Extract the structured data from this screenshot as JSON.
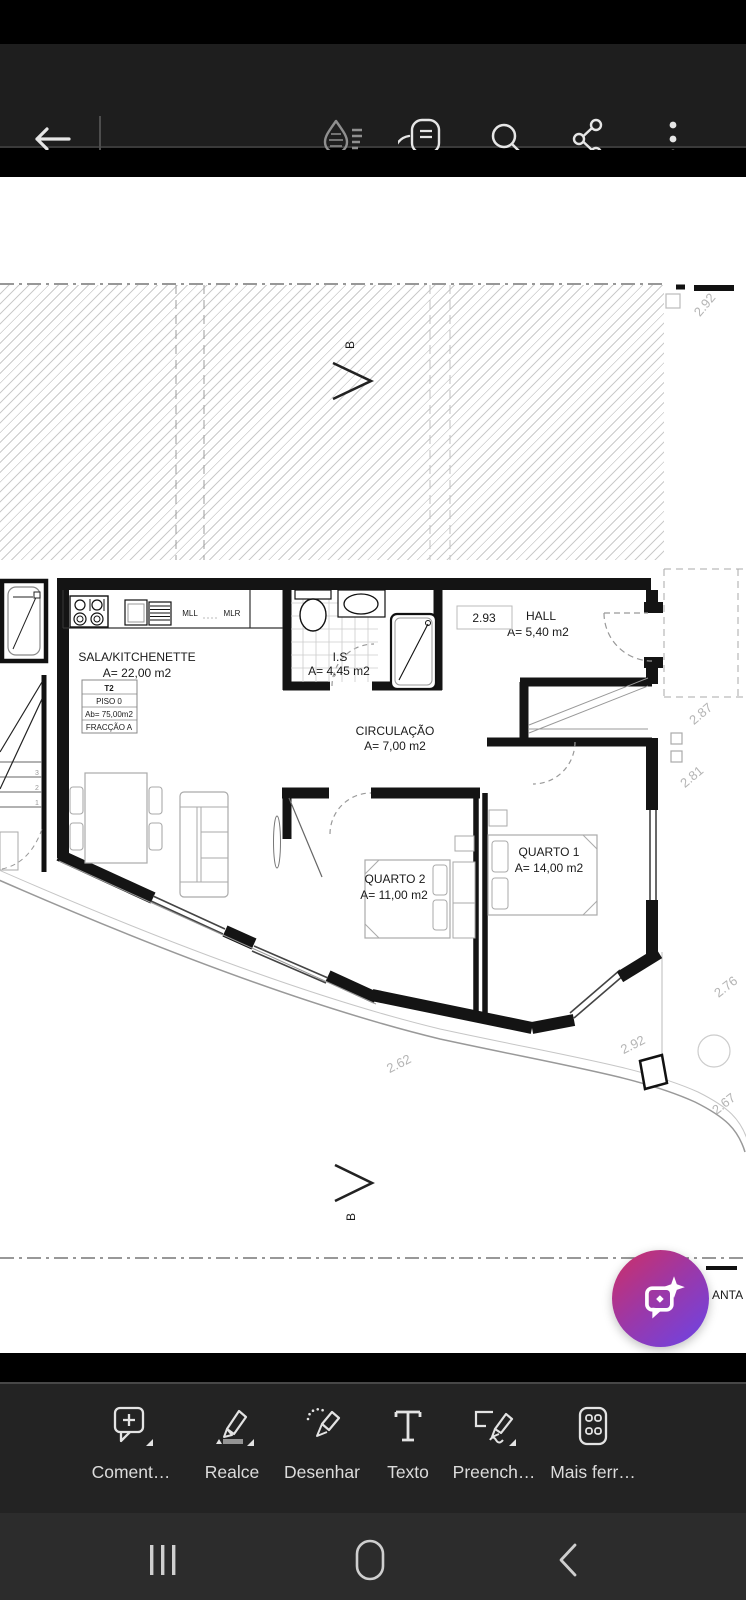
{
  "top_toolbar": {
    "icons": [
      {
        "name": "back-arrow"
      },
      {
        "name": "liquid-mode"
      },
      {
        "name": "view-settings"
      },
      {
        "name": "search"
      },
      {
        "name": "share"
      },
      {
        "name": "overflow-menu"
      }
    ]
  },
  "plan": {
    "rooms": [
      {
        "name": "SALA/KITCHENETTE",
        "area": "A= 22,00 m2"
      },
      {
        "name": "I.S",
        "area": "A= 4,45 m2"
      },
      {
        "name": "HALL",
        "area": "A= 5,40 m2"
      },
      {
        "name": "CIRCULAÇÃO",
        "area": "A= 7,00 m2"
      },
      {
        "name": "QUARTO 2",
        "area": "A= 11,00 m2"
      },
      {
        "name": "QUARTO 1",
        "area": "A= 14,00 m2"
      }
    ],
    "info_box": {
      "unit": "T2",
      "floor": "PISO 0",
      "built_area": "Ab= 75,00m2",
      "fraction": "FRACÇÃO A"
    },
    "kitchen": {
      "mll": "MLL",
      "mlr": "MLR"
    },
    "dims": {
      "hall_width": "2.93",
      "top_right": "2.92",
      "right_upper": "2.87",
      "right_lower": "2.81",
      "bottom_left": "2.62",
      "bottom_mid": "2.92",
      "bottom_right_upper": "2.76",
      "bottom_right_lower": "2.67"
    },
    "section_marker": "B",
    "stair_numbers": [
      "1",
      "2",
      "3"
    ],
    "cropped_text": "ANTA"
  },
  "fab": {
    "icon": "ai-assistant-chat-sparkle",
    "gradient_start": "#c9306c",
    "gradient_end": "#6f43e2"
  },
  "bottom_toolbar": {
    "items": [
      {
        "id": "comment",
        "label": "Coment…",
        "has_dropdown": true
      },
      {
        "id": "highlight",
        "label": "Realce",
        "has_dropdown": true
      },
      {
        "id": "draw",
        "label": "Desenhar",
        "has_dropdown": false
      },
      {
        "id": "text",
        "label": "Texto",
        "has_dropdown": false
      },
      {
        "id": "fill-sign",
        "label": "Preench…",
        "has_dropdown": true
      },
      {
        "id": "more-tools",
        "label": "Mais ferr…",
        "has_dropdown": false
      }
    ]
  },
  "android_nav": {
    "icons": [
      {
        "name": "recents"
      },
      {
        "name": "home"
      },
      {
        "name": "back"
      }
    ]
  }
}
